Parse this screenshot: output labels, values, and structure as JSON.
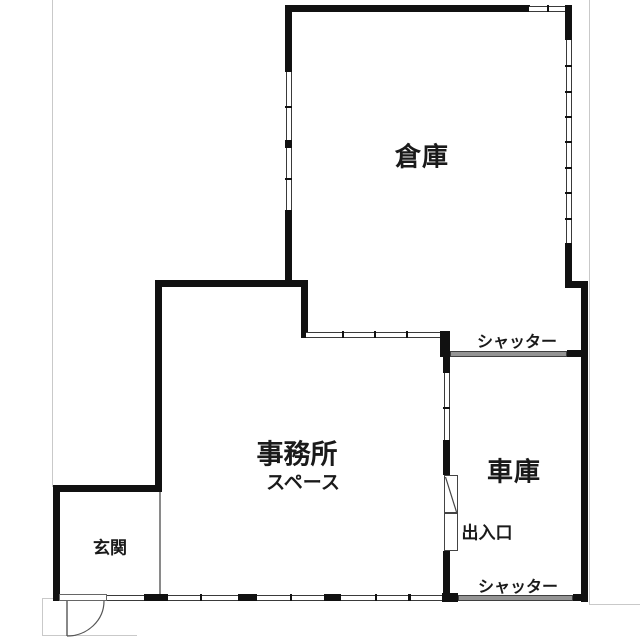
{
  "plan": {
    "type": "floor-plan",
    "language": "ja",
    "rooms": {
      "warehouse": {
        "label": "倉庫"
      },
      "office": {
        "line1": "事務所",
        "line2": "スペース"
      },
      "garage": {
        "label": "車庫"
      },
      "entrance": {
        "label": "玄関"
      }
    },
    "annotations": {
      "shutter_top": "シャッター",
      "shutter_bottom": "シャッター",
      "doorway": "出入口"
    },
    "colors": {
      "wall": "#111111",
      "window_edge": "#3a3a3a",
      "shutter_fill": "#949494",
      "boundary_line": "#c9c9c9",
      "text": "#1a1a1a",
      "background": "#ffffff"
    }
  }
}
